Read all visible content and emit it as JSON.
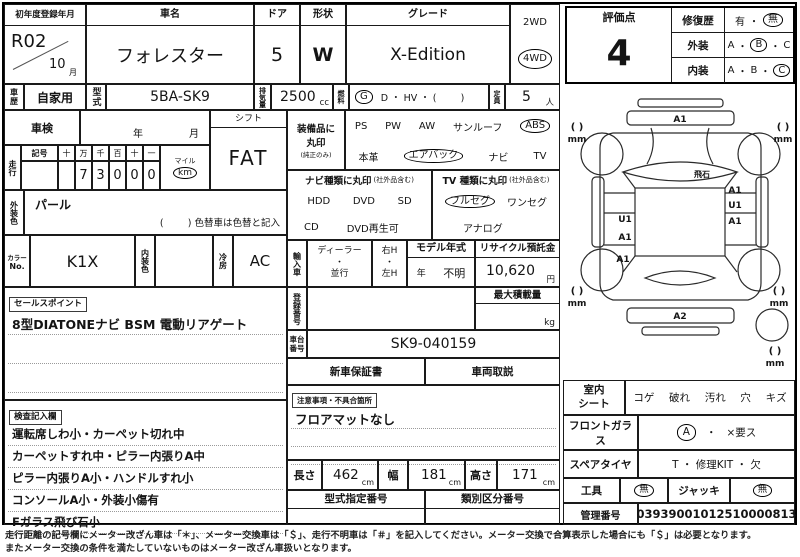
{
  "title_row": {
    "first_reg_label": "初年度登録年月",
    "first_reg_year": "R02",
    "first_reg_month": "10",
    "month_suffix": "月",
    "car_name_label": "車名",
    "car_name": "フォレスター",
    "door_label": "ドア",
    "door_value": "5",
    "shape_label": "形状",
    "shape_value": "W",
    "grade_label": "グレード",
    "grade_value": "X-Edition",
    "drive_2wd": "2WD",
    "drive_4wd": "4WD"
  },
  "spec_row": {
    "history_label": "車歴",
    "history_value": "自家用",
    "model_label": "型式",
    "model_value": "5BA-SK9",
    "disp_label": "排気量",
    "disp_value": "2500",
    "disp_unit": "cc",
    "fuel_label": "燃料",
    "fuel_circled": "G",
    "fuel_options": "D ・ HV ・ (        )",
    "capacity_label": "定員",
    "capacity_value": "5",
    "capacity_unit": "人"
  },
  "shaken": {
    "label": "車検",
    "year_label": "年",
    "month_label": "月"
  },
  "shift": {
    "label": "シフト",
    "value": "FAT"
  },
  "mileage": {
    "label": "走行",
    "sign_label": "記号",
    "digit_headers": [
      "十",
      "万",
      "千",
      "百",
      "十",
      "一"
    ],
    "digits": [
      "",
      "7",
      "3",
      "0",
      "0",
      "0"
    ],
    "mile_label": "マイル",
    "km_label": "km"
  },
  "ext_color": {
    "label": "外装色",
    "value": "パール",
    "note": "(        ) 色替車は色替と記入"
  },
  "color_row": {
    "color_no_label_1": "カラー",
    "color_no_label_2": "No.",
    "color_no_value": "K1X",
    "int_color_label": "内装色",
    "cooling_label": "冷房",
    "cooling_value": "AC"
  },
  "sales_point": {
    "label": "セールスポイント",
    "text": "8型DIATONEナビ BSM 電動リアゲート"
  },
  "inspection": {
    "label": "検査記入欄",
    "lines": [
      "運転席しわ小・カーペット切れ中",
      "カーペットすれ中・ピラー内張りA中",
      "ピラー内張りA小・ハンドルすれ小",
      "コンソールA小・外装小傷有",
      "Fガラス飛び石小"
    ]
  },
  "equipment": {
    "label_1": "装備品に",
    "label_2": "丸印",
    "label_note": "(純正のみ)",
    "row1": [
      "PS",
      "PW",
      "AW",
      "サンルーフ",
      "ABS"
    ],
    "row2": [
      "本革",
      "エアバック",
      "ナビ",
      "TV"
    ]
  },
  "nav": {
    "header": "ナビ種類に丸印",
    "header_note": "(社外品含む)",
    "row1": [
      "HDD",
      "DVD",
      "SD"
    ],
    "row2": [
      "CD",
      "DVD再生可"
    ]
  },
  "tv": {
    "header": "TV 種類に丸印",
    "header_note": "(社外品含む)",
    "row1": [
      "フルセグ",
      "ワンセグ"
    ],
    "row2": [
      "アナログ"
    ]
  },
  "import_row": {
    "label": "輸入車",
    "dealer": "ディーラー",
    "dot": "・",
    "parallel": "並行",
    "right_h": "右H",
    "left_h": "左H",
    "model_year_label": "モデル年式",
    "model_year_year": "年",
    "model_year_value": "不明",
    "recycle_label": "リサイクル預託金",
    "recycle_value": "10,620",
    "recycle_unit": "円"
  },
  "registration": {
    "label": "登録番号",
    "max_load_label": "最大積載量",
    "max_load_unit": "kg"
  },
  "chassis": {
    "label_1": "車台",
    "label_2": "番号",
    "value": "SK9-040159"
  },
  "docs": {
    "warranty": "新車保証書",
    "manual": "車両取説"
  },
  "notes": {
    "label": "注意事項・不具合箇所",
    "text": "フロアマットなし"
  },
  "dimensions": {
    "length_label": "長さ",
    "length_value": "462",
    "width_label": "幅",
    "width_value": "181",
    "height_label": "高さ",
    "height_value": "171",
    "unit": "cm"
  },
  "type_numbers": {
    "type_label": "型式指定番号",
    "class_label": "類別区分番号"
  },
  "evaluation": {
    "score_label": "評価点",
    "score": "4",
    "repair_label": "修復歴",
    "repair_yes": "有",
    "repair_no": "無",
    "exterior_label": "外装",
    "interior_label": "内装",
    "grade_a": "A",
    "grade_b": "B",
    "grade_c": "C",
    "dot": "・"
  },
  "diagram": {
    "front_label": "A1",
    "windshield_note": "飛石",
    "right_labels": [
      "A1",
      "U1",
      "A1"
    ],
    "left_labels": [
      "U1",
      "A1",
      "A1"
    ],
    "rear_label": "A2",
    "bracket": "(  )",
    "mm": "mm"
  },
  "condition": {
    "seat_label_1": "室内",
    "seat_label_2": "シート",
    "seat_items": [
      "コゲ",
      "破れ",
      "汚れ",
      "穴",
      "キズ"
    ],
    "windshield_label": "フロントガラス",
    "windshield_value": "A",
    "windshield_dot": "・",
    "windshield_note": "×要ス",
    "spare_label": "スペアタイヤ",
    "spare_value": "T ・ 修理KIT ・ 欠",
    "tools_label": "工具",
    "tools_value": "無",
    "jack_label": "ジャッキ",
    "jack_value": "無",
    "control_label": "管理番号",
    "control_value": "03939001012510000813"
  },
  "footer": {
    "line1": "走行距離の記号欄にメーター改ざん車は「＊」、メーター交換車は「＄」、走行不明車は「＃」を記入してください。メーター交換で合算表示した場合にも「＄」は必要となります。",
    "line2": "またメーター交換の条件を満たしていないものはメーター改ざん車扱いとなります。"
  }
}
